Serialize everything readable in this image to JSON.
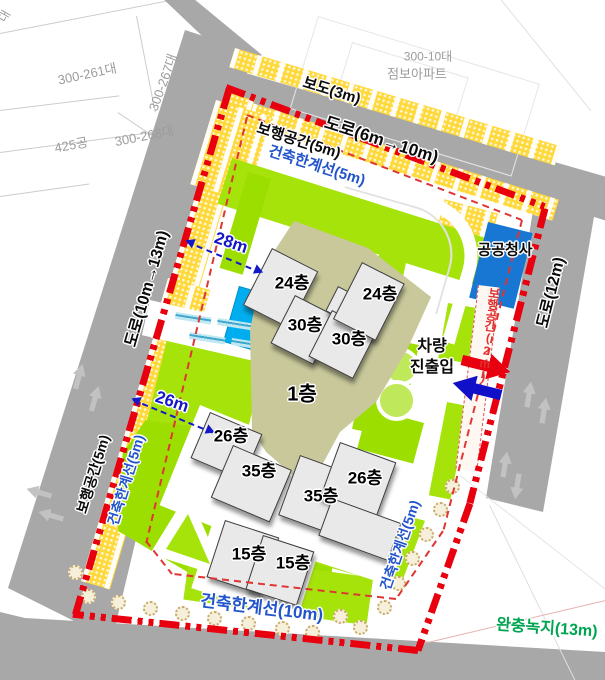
{
  "title": "아파트 단지 배치도",
  "colors": {
    "boundary_red": "#e8000f",
    "setback_blue": "#2255cc",
    "buffer_green": "#00a550",
    "dimension_blue": "#1418c8",
    "road_gray": "#a8a8a8",
    "lawn_green": "#a6e30b",
    "podium_olive": "#c8c89b",
    "pond_blue": "#00aeef",
    "public_building_blue": "#1877d2",
    "pedestrian_yellow": "#ffd93b"
  },
  "parcels": {
    "partial": "대",
    "p1": "300-261대",
    "p2": "300-267대",
    "p3": "300-268대",
    "p4": "425공",
    "apt_lot": "300-10대",
    "apt_name": "점보아파트"
  },
  "roads": {
    "sidewalk_top": "보도(3m)",
    "top": "도로(6m→10m)",
    "left": "도로(10m→13m)",
    "right": "도로(12m)"
  },
  "setbacks": {
    "ped_top": "보행공간(5m)",
    "limit_top": "건축한계선(5m)",
    "ped_left": "보행공간(5m)",
    "limit_left": "건축한계선(5m)",
    "ped_right": "보행공간(2m)",
    "limit_southeast": "건축한계선(5m)",
    "limit_bottom": "건축한계선(10m)",
    "buffer": "완충녹지(13m)"
  },
  "buildings": {
    "podium": "1층",
    "n1": "24층",
    "n2": "30층",
    "n3": "30층",
    "n4": "24층",
    "w1": "26층",
    "w2": "35층",
    "e1": "35층",
    "e2": "26층",
    "s1": "15층",
    "s2": "15층",
    "public": "공공청사"
  },
  "dimensions": {
    "west": "28m",
    "southwest": "26m"
  },
  "vehicle_access": {
    "line1": "차량",
    "line2": "진출입"
  }
}
